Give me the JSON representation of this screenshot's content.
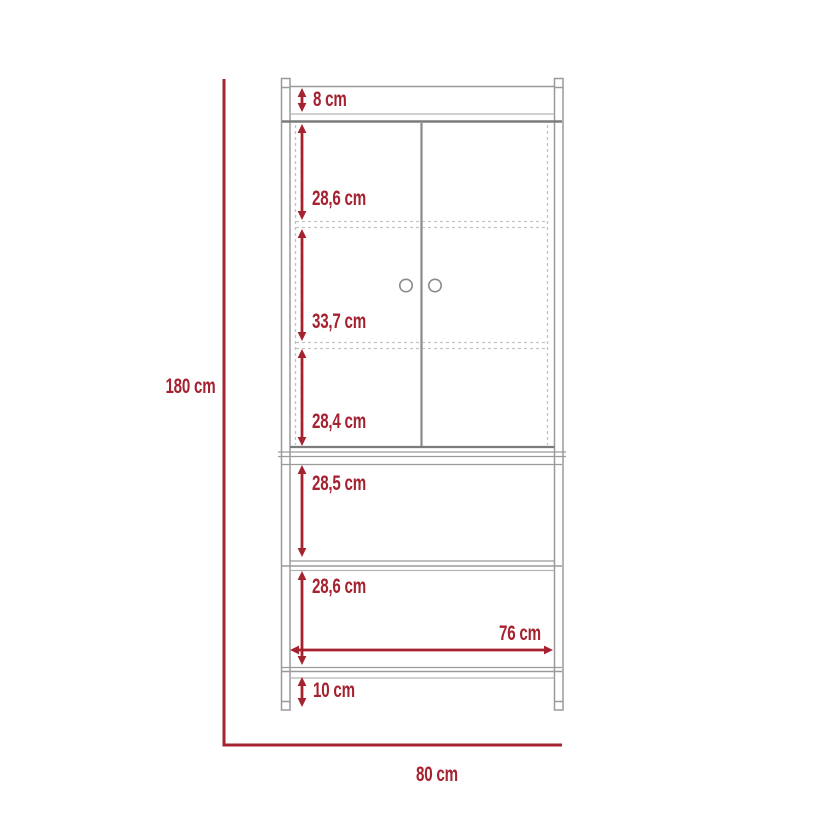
{
  "diagram": {
    "title": "cabinet-dimension-drawing",
    "measurements": {
      "top_rail": "8 cm",
      "upper_door_section": "28,6 cm",
      "middle_door_section": "33,7 cm",
      "lower_door_section": "28,4 cm",
      "open_shelf_top": "28,5 cm",
      "open_shelf_bottom": "28,6 cm",
      "inner_width": "76 cm",
      "base_height": "10 cm",
      "overall_height": "180 cm",
      "overall_width": "80 cm"
    },
    "colors": {
      "dimension_red": "#A52230",
      "line_gray": "#9A9A9A",
      "line_dark_gray": "#7B7B7B",
      "dashed_gray": "#C2C2C2",
      "background": "#FFFFFF"
    }
  }
}
